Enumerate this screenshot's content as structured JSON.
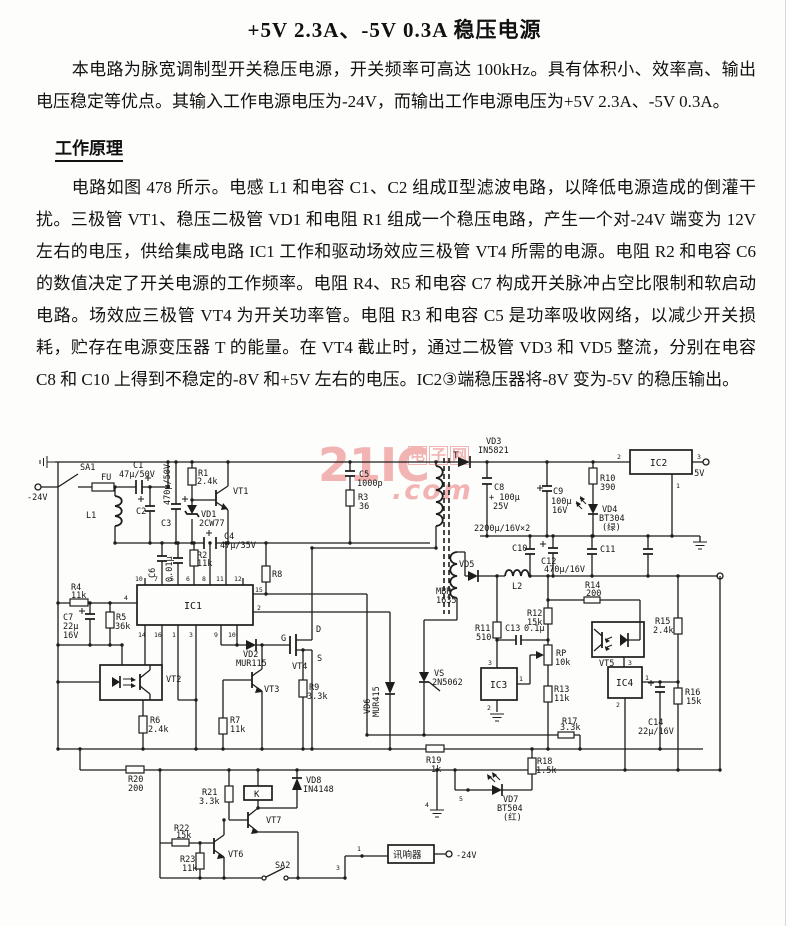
{
  "document": {
    "title": "+5V 2.3A、-5V 0.3A 稳压电源",
    "intro": "本电路为脉宽调制型开关稳压电源，开关频率可高达 100kHz。具有体积小、效率高、输出电压稳定等优点。其输入工作电源电压为-24V，而输出工作电源电压为+5V 2.3A、-5V 0.3A。",
    "section_heading": "工作原理",
    "body": "电路如图 478 所示。电感 L1 和电容 C1、C2 组成Ⅱ型滤波电路，以降低电源造成的倒灌干扰。三极管 VT1、稳压二极管 VD1 和电阻 R1 组成一个稳压电路，产生一个对-24V 端变为 12V 左右的电压，供给集成电路 IC1 工作和驱动场效应三极管 VT4 所需的电源。电阻 R2 和电容 C6 的数值决定了开关电源的工作频率。电阻 R4、R5 和电容 C7 构成开关脉冲占空比限制和软启动电路。场效应三极管 VT4 为开关功率管。电阻 R3 和电容 C5 是功率吸收网络，以减少开关损耗，贮存在电源变压器 T 的能量。在 VT4 截止时，通过二极管 VD3 和 VD5 整流，分别在电容 C8 和 C10 上得到不稳定的-8V 和+5V 左右的电压。IC2③端稳压器将-8V 变为-5V 的稳压输出。"
  },
  "watermark": {
    "brand": "21IC",
    "cn": "电子网",
    "suffix": ".com",
    "color": "#f0a2a2"
  },
  "schematic": {
    "labels": [
      {
        "t": "SA1",
        "x": 80,
        "y": 470
      },
      {
        "t": "FU",
        "x": 101,
        "y": 480
      },
      {
        "t": "-24V",
        "x": 27,
        "y": 500
      },
      {
        "t": "C1",
        "x": 133,
        "y": 468
      },
      {
        "t": "47μ/50V",
        "x": 119,
        "y": 477
      },
      {
        "t": "470μ/50V",
        "x": 170,
        "y": 505,
        "r": -90
      },
      {
        "t": "L1",
        "x": 86,
        "y": 518
      },
      {
        "t": "C2",
        "x": 136,
        "y": 514
      },
      {
        "t": "C3",
        "x": 161,
        "y": 526
      },
      {
        "t": "R1",
        "x": 198,
        "y": 476
      },
      {
        "t": "2.4k",
        "x": 197,
        "y": 484
      },
      {
        "t": "VT1",
        "x": 233,
        "y": 494
      },
      {
        "t": "VD1",
        "x": 201,
        "y": 517
      },
      {
        "t": "2CW77",
        "x": 199,
        "y": 526
      },
      {
        "t": "C4",
        "x": 224,
        "y": 539
      },
      {
        "t": "47μ/35V",
        "x": 220,
        "y": 548
      },
      {
        "t": "C6",
        "x": 155,
        "y": 578,
        "r": -90
      },
      {
        "t": "0.01μ",
        "x": 172,
        "y": 582,
        "r": -90
      },
      {
        "t": "R2",
        "x": 197,
        "y": 558
      },
      {
        "t": "11k",
        "x": 197,
        "y": 566
      },
      {
        "t": "R4",
        "x": 71,
        "y": 590
      },
      {
        "t": "11k",
        "x": 71,
        "y": 598
      },
      {
        "t": "C7",
        "x": 63,
        "y": 620
      },
      {
        "t": "22μ",
        "x": 63,
        "y": 629
      },
      {
        "t": "16V",
        "x": 63,
        "y": 638
      },
      {
        "t": "R5",
        "x": 116,
        "y": 620
      },
      {
        "t": "36k",
        "x": 115,
        "y": 629
      },
      {
        "t": "R8",
        "x": 272,
        "y": 577
      },
      {
        "t": "IC1",
        "x": 184,
        "y": 609,
        "s": 10
      },
      {
        "t": "10",
        "x": 135,
        "y": 581,
        "s": 6.5
      },
      {
        "t": "7",
        "x": 154,
        "y": 581,
        "s": 6.5
      },
      {
        "t": "5",
        "x": 170,
        "y": 581,
        "s": 6.5
      },
      {
        "t": "6",
        "x": 186,
        "y": 581,
        "s": 6.5
      },
      {
        "t": "8",
        "x": 202,
        "y": 581,
        "s": 6.5
      },
      {
        "t": "11",
        "x": 216,
        "y": 581,
        "s": 6.5
      },
      {
        "t": "12",
        "x": 234,
        "y": 581,
        "s": 6.5
      },
      {
        "t": "4",
        "x": 124,
        "y": 600,
        "s": 6.5
      },
      {
        "t": "15",
        "x": 255,
        "y": 592,
        "s": 6.5
      },
      {
        "t": "2",
        "x": 257,
        "y": 610,
        "s": 6.5
      },
      {
        "t": "14",
        "x": 138,
        "y": 637,
        "s": 6.5
      },
      {
        "t": "16",
        "x": 154,
        "y": 637,
        "s": 6.5
      },
      {
        "t": "1",
        "x": 172,
        "y": 637,
        "s": 6.5
      },
      {
        "t": "3",
        "x": 189,
        "y": 637,
        "s": 6.5
      },
      {
        "t": "9",
        "x": 214,
        "y": 637,
        "s": 6.5
      },
      {
        "t": "10",
        "x": 228,
        "y": 637,
        "s": 6.5
      },
      {
        "t": "VT2",
        "x": 166,
        "y": 682
      },
      {
        "t": "VD2",
        "x": 243,
        "y": 657
      },
      {
        "t": "MUR115",
        "x": 236,
        "y": 666
      },
      {
        "t": "VT3",
        "x": 264,
        "y": 692
      },
      {
        "t": "R9",
        "x": 309,
        "y": 690
      },
      {
        "t": "3.3k",
        "x": 307,
        "y": 699
      },
      {
        "t": "G",
        "x": 281,
        "y": 641
      },
      {
        "t": "D",
        "x": 316,
        "y": 632
      },
      {
        "t": "S",
        "x": 317,
        "y": 661
      },
      {
        "t": "VT4",
        "x": 292,
        "y": 669
      },
      {
        "t": "R6",
        "x": 150,
        "y": 723
      },
      {
        "t": "2.4k",
        "x": 148,
        "y": 732
      },
      {
        "t": "R7",
        "x": 230,
        "y": 723
      },
      {
        "t": "11k",
        "x": 230,
        "y": 732
      },
      {
        "t": "C5",
        "x": 359,
        "y": 477
      },
      {
        "t": "1000p",
        "x": 357,
        "y": 486
      },
      {
        "t": "R3",
        "x": 358,
        "y": 500
      },
      {
        "t": "36",
        "x": 359,
        "y": 509
      },
      {
        "t": "T",
        "x": 453,
        "y": 458,
        "s": 9
      },
      {
        "t": "VD3",
        "x": 486,
        "y": 444
      },
      {
        "t": "IN5821",
        "x": 478,
        "y": 453
      },
      {
        "t": "IC2",
        "x": 650,
        "y": 466,
        "s": 9.5
      },
      {
        "t": "2",
        "x": 617,
        "y": 459,
        "s": 6.5
      },
      {
        "t": "3",
        "x": 697,
        "y": 459,
        "s": 6.5
      },
      {
        "t": "1",
        "x": 676,
        "y": 488,
        "s": 6.5
      },
      {
        "t": "-5V",
        "x": 689,
        "y": 476
      },
      {
        "t": "C8",
        "x": 494,
        "y": 490
      },
      {
        "t": "+ 100μ",
        "x": 489,
        "y": 500
      },
      {
        "t": "25V",
        "x": 493,
        "y": 509
      },
      {
        "t": "C9",
        "x": 553,
        "y": 494
      },
      {
        "t": "100μ",
        "x": 551,
        "y": 504
      },
      {
        "t": "16V",
        "x": 552,
        "y": 513
      },
      {
        "t": "R10",
        "x": 600,
        "y": 481
      },
      {
        "t": "390",
        "x": 600,
        "y": 490
      },
      {
        "t": "VD4",
        "x": 602,
        "y": 512
      },
      {
        "t": "BT304",
        "x": 599,
        "y": 521
      },
      {
        "t": "(绿)",
        "x": 602,
        "y": 530
      },
      {
        "t": "2200μ/16V×2",
        "x": 474,
        "y": 531
      },
      {
        "t": "C10",
        "x": 512,
        "y": 551
      },
      {
        "t": "C11",
        "x": 600,
        "y": 552
      },
      {
        "t": "C12",
        "x": 541,
        "y": 564
      },
      {
        "t": "470μ/16V",
        "x": 544,
        "y": 572
      },
      {
        "t": "VD5",
        "x": 459,
        "y": 567
      },
      {
        "t": "MBR",
        "x": 436,
        "y": 594
      },
      {
        "t": "1635",
        "x": 436,
        "y": 603
      },
      {
        "t": "L2",
        "x": 512,
        "y": 589
      },
      {
        "t": "R14",
        "x": 585,
        "y": 588
      },
      {
        "t": "200",
        "x": 586,
        "y": 596
      },
      {
        "t": "R12",
        "x": 527,
        "y": 616
      },
      {
        "t": "15k",
        "x": 527,
        "y": 625
      },
      {
        "t": "R11",
        "x": 475,
        "y": 631
      },
      {
        "t": "510",
        "x": 476,
        "y": 640
      },
      {
        "t": "C13",
        "x": 505,
        "y": 631
      },
      {
        "t": "0.1μ",
        "x": 524,
        "y": 631
      },
      {
        "t": "RP",
        "x": 556,
        "y": 656
      },
      {
        "t": "10k",
        "x": 555,
        "y": 665
      },
      {
        "t": "R13",
        "x": 554,
        "y": 692
      },
      {
        "t": "11k",
        "x": 554,
        "y": 701
      },
      {
        "t": "IC3",
        "x": 490,
        "y": 688,
        "s": 9.5
      },
      {
        "t": "3",
        "x": 488,
        "y": 665,
        "s": 6.5
      },
      {
        "t": "1",
        "x": 519,
        "y": 681,
        "s": 6.5
      },
      {
        "t": "2",
        "x": 487,
        "y": 710,
        "s": 6.5
      },
      {
        "t": "VT5",
        "x": 599,
        "y": 666
      },
      {
        "t": "IC4",
        "x": 616,
        "y": 686,
        "s": 9.5
      },
      {
        "t": "3",
        "x": 628,
        "y": 665,
        "s": 6.5
      },
      {
        "t": "1",
        "x": 645,
        "y": 680,
        "s": 6.5
      },
      {
        "t": "2",
        "x": 616,
        "y": 707,
        "s": 6.5
      },
      {
        "t": "R15",
        "x": 655,
        "y": 624
      },
      {
        "t": "2.4k",
        "x": 653,
        "y": 633
      },
      {
        "t": "R16",
        "x": 685,
        "y": 695
      },
      {
        "t": "15k",
        "x": 686,
        "y": 704
      },
      {
        "t": "C14",
        "x": 648,
        "y": 725
      },
      {
        "t": "22μ/16V",
        "x": 638,
        "y": 734
      },
      {
        "t": "VS",
        "x": 434,
        "y": 676
      },
      {
        "t": "2N5062",
        "x": 432,
        "y": 685
      },
      {
        "t": "VD6",
        "x": 370,
        "y": 714,
        "r": -90
      },
      {
        "t": "MUR415",
        "x": 379,
        "y": 717,
        "r": -90
      },
      {
        "t": "R19",
        "x": 426,
        "y": 763
      },
      {
        "t": "1k",
        "x": 431,
        "y": 772
      },
      {
        "t": "R18",
        "x": 537,
        "y": 764
      },
      {
        "t": "1.5k",
        "x": 536,
        "y": 773
      },
      {
        "t": "R17",
        "x": 562,
        "y": 724
      },
      {
        "t": "3.3k",
        "x": 560,
        "y": 730
      },
      {
        "t": "VD7",
        "x": 503,
        "y": 802
      },
      {
        "t": "BT504",
        "x": 497,
        "y": 811
      },
      {
        "t": "(红)",
        "x": 503,
        "y": 820
      },
      {
        "t": "5",
        "x": 459,
        "y": 801,
        "s": 6.5
      },
      {
        "t": "4",
        "x": 425,
        "y": 807,
        "s": 6.5
      },
      {
        "t": "R20",
        "x": 128,
        "y": 782
      },
      {
        "t": "200",
        "x": 128,
        "y": 791
      },
      {
        "t": "R21",
        "x": 202,
        "y": 795
      },
      {
        "t": "3.3k",
        "x": 199,
        "y": 804
      },
      {
        "t": "K",
        "x": 254,
        "y": 797,
        "s": 9
      },
      {
        "t": "VD8",
        "x": 306,
        "y": 783
      },
      {
        "t": "IN4148",
        "x": 303,
        "y": 792
      },
      {
        "t": "VT7",
        "x": 266,
        "y": 823
      },
      {
        "t": "VT6",
        "x": 228,
        "y": 857
      },
      {
        "t": "R22",
        "x": 174,
        "y": 831
      },
      {
        "t": "15k",
        "x": 176,
        "y": 838
      },
      {
        "t": "R23",
        "x": 180,
        "y": 862
      },
      {
        "t": "11k",
        "x": 182,
        "y": 871
      },
      {
        "t": "SA2",
        "x": 275,
        "y": 868
      },
      {
        "t": "3",
        "x": 336,
        "y": 870,
        "s": 6.5
      },
      {
        "t": "1",
        "x": 357,
        "y": 851,
        "s": 6.5
      },
      {
        "t": "讯响器",
        "x": 393,
        "y": 858,
        "s": 9.5
      },
      {
        "t": "-24V",
        "x": 456,
        "y": 858
      }
    ]
  }
}
